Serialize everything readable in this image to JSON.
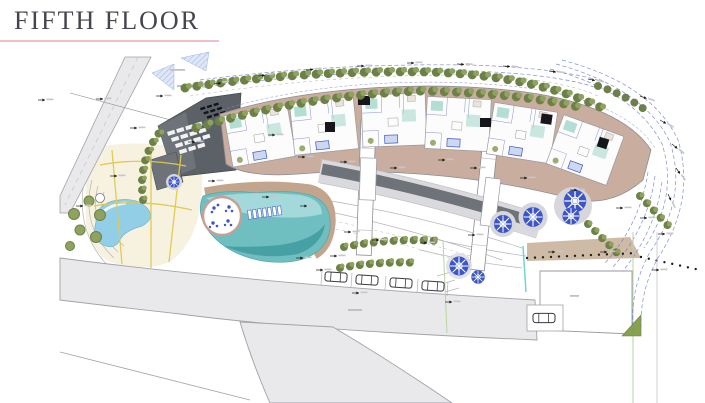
{
  "header": {
    "title": "FIFTH FLOOR"
  },
  "plan": {
    "description": "architectural site plan, fifth floor level",
    "elements": {
      "fan_building": "dark roof building with solar panel array",
      "main_building": "curved residential block with six apartment units",
      "pool_main": "kidney-shaped pool with circular island and lounge chairs",
      "pool_small": "free-form pool with yellow path grid",
      "parked_cars": 5,
      "blue_trees": 6,
      "roads": "perimeter road, bottom road with branch, right entrance drive"
    }
  },
  "palette": {
    "title": "#45454d",
    "rule": "#eec1c8",
    "road": "#e9e9eb",
    "roadEdge": "#a2a2a8",
    "dark": "#5b6167",
    "dark2": "#6d7379",
    "panel": "#f2f2f2",
    "bld": "#c9ad9e",
    "bldEdge": "#8d8d94",
    "unit": "#fcfcfd",
    "teal": "#a7d8cb",
    "core": "#17171b",
    "pool": "#6fbfc0",
    "poolDark": "#47a1a4",
    "poolLight": "#a8dbde",
    "deck": "#c3a48c",
    "spool": "#92cfe6",
    "cream": "#f6f0da",
    "yline": "#dfc94f",
    "tree": "#8fa35e",
    "treeDark": "#6d8047",
    "btree": "#3c55c8",
    "gcirc": "#d6d6db",
    "blue": "#6a79d8",
    "tan2": "#c9b29b",
    "cyan": "#70d4d8",
    "ring": "#c79f96",
    "greenTri": "#86a24c",
    "greenLn": "#b9d4a4"
  }
}
